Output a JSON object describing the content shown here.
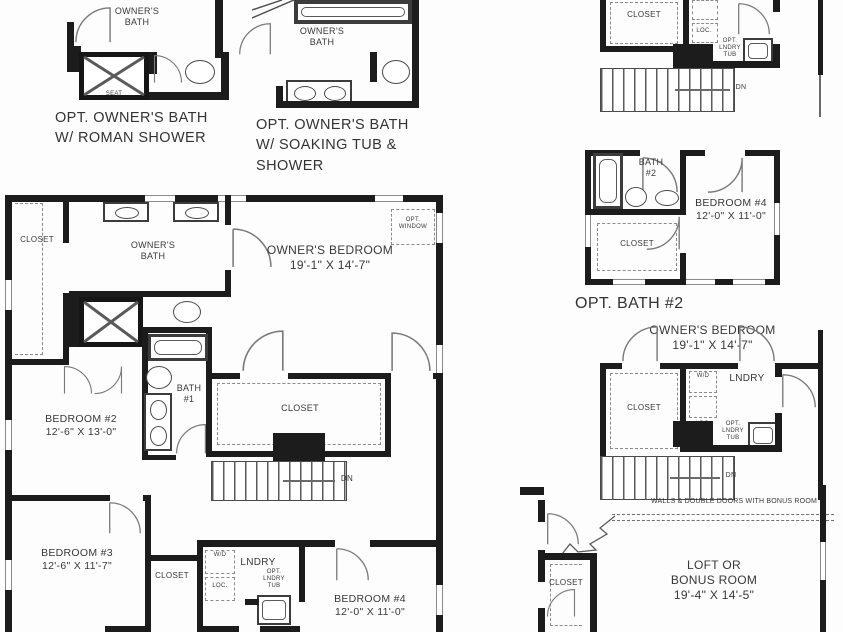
{
  "colors": {
    "paper": "#fdfdfd",
    "ink": "#1c1c1c"
  },
  "roman_detail": {
    "room": "OWNER'S\nBATH",
    "seat": "SEAT",
    "caption": "OPT. OWNER'S BATH\nW/ ROMAN SHOWER"
  },
  "soaking_detail": {
    "room": "OWNER'S\nBATH",
    "caption": "OPT. OWNER'S BATH\nW/ SOAKING TUB &\nSHOWER"
  },
  "laundry_detail": {
    "closet": "CLOSET",
    "loc": "LOC.",
    "opt_tub": "OPT.\nLNDRY\nTUB",
    "dn": "DN"
  },
  "bath2_detail": {
    "bath": "BATH\n#2",
    "closet": "CLOSET",
    "bedroom4": "BEDROOM #4\n12'-0\" X 11'-0\"",
    "caption": "OPT. BATH #2"
  },
  "owners_detail": {
    "header": "OWNER'S BEDROOM\n19'-1\" X 14'-7\"",
    "closet": "CLOSET",
    "lndry": "LNDRY",
    "wd": "W/D",
    "loc": "LOC.",
    "opt_tub": "OPT.\nLNDRY\nTUB",
    "dn": "DN"
  },
  "loft_detail": {
    "annotation": "WALLS & DOUBLE DOORS WITH BONUS ROOM",
    "closet": "CLOSET",
    "room": "LOFT OR\nBONUS ROOM\n19'-4\" X 14'-5\""
  },
  "main_plan": {
    "closet_tl": "CLOSET",
    "owners_bath": "OWNER'S\nBATH",
    "owners_bedroom": "OWNER'S BEDROOM\n19'-1\" X 14'-7\"",
    "opt_window": "OPT.\nWINDOW",
    "bedroom2": "BEDROOM #2\n12'-6\" X 13'-0\"",
    "bath1": "BATH\n#1",
    "closet_wic": "CLOSET",
    "dn": "DN",
    "bedroom3": "BEDROOM #3\n12'-6\" X 11'-7\"",
    "closet_b3": "CLOSET",
    "lndry": "LNDRY",
    "wd": "W/D",
    "loc": "LOC.",
    "opt_tub": "OPT.\nLNDRY\nTUB",
    "bedroom4": "BEDROOM #4\n12'-0\" X 11'-0\""
  }
}
